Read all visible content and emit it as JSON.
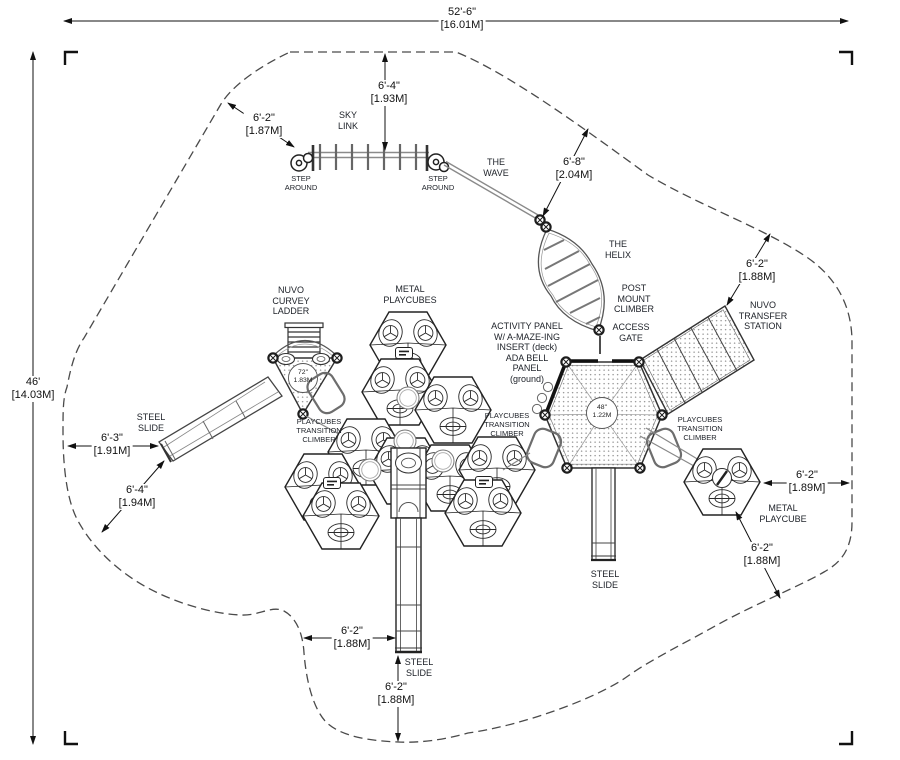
{
  "title": "Playground equipment plan view drawing",
  "colors": {
    "background": "#ffffff",
    "linework": "#222222",
    "boundary_dash": "#4a4a4a",
    "text": "#1c1c1c"
  },
  "dimensions": {
    "overall_width": "52'-6\"\n[16.01M]",
    "overall_depth": "46'\n[14.03M]",
    "sky_link_clearance": "6'-2\"\n[1.87M]",
    "sky_link_to_border": "6'-4\"\n[1.93M]",
    "wave_clearance": "6'-8\"\n[2.04M]",
    "transfer_clearance": "6'-2\"\n[1.88M]",
    "playcube_right_clearance": "6'-2\"\n[1.89M]",
    "playcube_lower_clearance": "6'-2\"\n[1.88M]",
    "slide_left_clearance": "6'-3\"\n[1.91M]",
    "slide_left_lower_clearance": "6'-4\"\n[1.94M]",
    "slide_bottom_side_clearance": "6'-2\"\n[1.88M]",
    "slide_bottom_exit_clearance": "6'-2\"\n[1.88M]"
  },
  "equipment": {
    "sky_link": "SKY\nLINK",
    "step_around_left": "STEP\nAROUND",
    "step_around_right": "STEP\nAROUND",
    "the_wave": "THE\nWAVE",
    "the_helix": "THE\nHELIX",
    "post_mount_climber": "POST\nMOUNT\nCLIMBER",
    "access_gate": "ACCESS\nGATE",
    "nuvo_transfer_station": "NUVO\nTRANSFER\nSTATION",
    "nuvo_curvey_ladder": "NUVO\nCURVEY\nLADDER",
    "metal_playcubes": "METAL\nPLAYCUBES",
    "metal_playcube": "METAL\nPLAYCUBE",
    "activity_panel": "ACTIVITY PANEL\nW/ A-MAZE-ING\nINSERT (deck)\nADA BELL\nPANEL\n(ground)",
    "playcubes_transition_climber_left": "PLAYCUBES\nTRANSITION\nCLIMBER",
    "playcubes_transition_climber_mid": "PLAYCUBES\nTRANSITION\nCLIMBER",
    "playcubes_transition_climber_right": "PLAYCUBES\nTRANSITION\nCLIMBER",
    "steel_slide_left": "STEEL\nSLIDE",
    "steel_slide_bottom": "STEEL\nSLIDE",
    "steel_slide_right": "STEEL\nSLIDE",
    "triangle_deck_size": "72\"\n1.83M",
    "hex_deck_size": "48\"\n1.22M"
  }
}
